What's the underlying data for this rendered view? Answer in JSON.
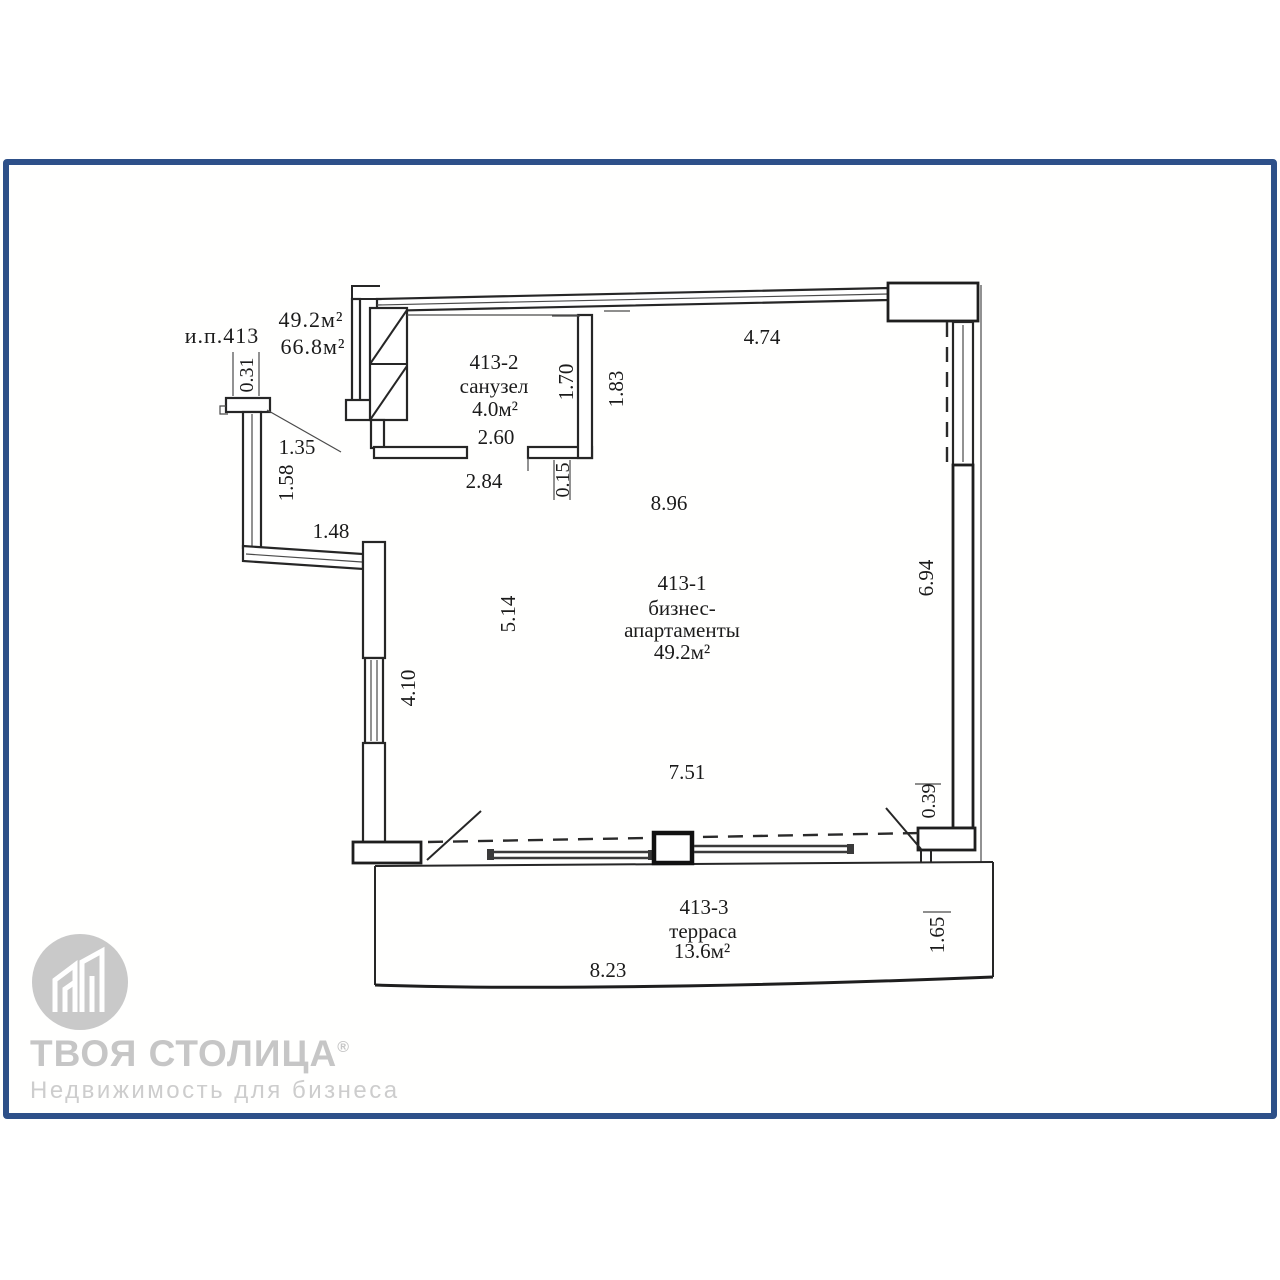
{
  "frame": {
    "border_color": "#2e5089"
  },
  "plan": {
    "unit_label": "и.п.413",
    "area_line1": "49.2м²",
    "area_line2": "66.8м²",
    "room_apartment": {
      "id": "413-1",
      "name1": "бизнес-",
      "name2": "апартаменты",
      "area": "49.2м²"
    },
    "room_bathroom": {
      "id": "413-2",
      "name": "санузел",
      "area": "4.0м²"
    },
    "room_terrace": {
      "id": "413-3",
      "name": "терраса",
      "area": "13.6м²"
    },
    "dims": {
      "d031": "0.31",
      "d135": "1.35",
      "d158": "1.58",
      "d148": "1.48",
      "d260": "2.60",
      "d284": "2.84",
      "d015": "0.15",
      "d170": "1.70",
      "d183": "1.83",
      "d474": "4.74",
      "d896": "8.96",
      "d514": "5.14",
      "d410": "4.10",
      "d694": "6.94",
      "d751": "7.51",
      "d039": "0.39",
      "d823": "8.23",
      "d165": "1.65"
    }
  },
  "logo": {
    "brand": "ТВОЯ СТОЛИЦА",
    "reg": "®",
    "subtitle": "Недвижимость для бизнеса"
  }
}
